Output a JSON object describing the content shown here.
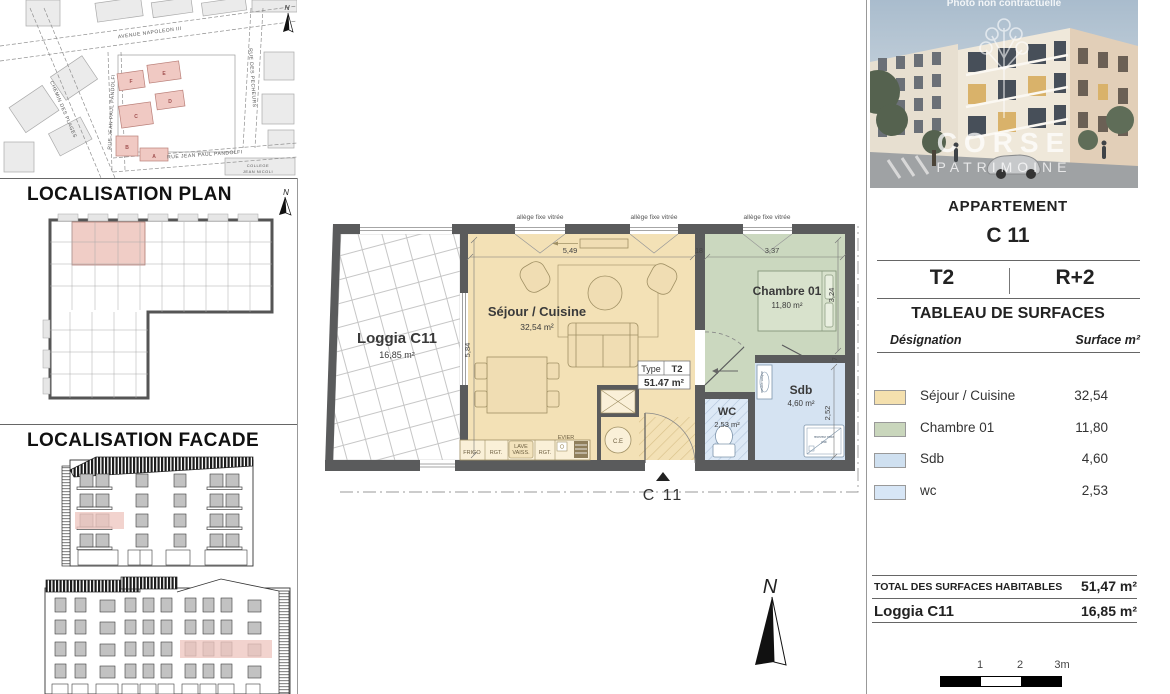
{
  "photo": {
    "caption": "Photo non contractuelle",
    "watermark_line1": "CORSE",
    "watermark_line2": "PATRIMOINE"
  },
  "site_map": {
    "north": "N",
    "streets": {
      "avenue": "AVENUE NAPOLEON III",
      "chemin": "CHEMIN DES PLAGES",
      "pandolfi_v": "RUE JEAN PAUL PANDOLFI",
      "pandolfi_h": "RUE JEAN PAUL PANDOLFI",
      "pecheurs": "RUE DES PECHEURS",
      "college_line1": "COLLEGE",
      "college_line2": "JEAN NICOLI"
    },
    "buildings": {
      "a": "A",
      "b": "B",
      "c": "C",
      "d": "D",
      "e": "E",
      "f": "F"
    }
  },
  "sections": {
    "plan_title": "LOCALISATION PLAN",
    "plan_north": "N",
    "facade_title": "LOCALISATION FACADE"
  },
  "floorplan": {
    "north": "N",
    "window_labels": {
      "w1": "allège fixe vitrée",
      "w2": "allège fixe vitrée",
      "w3": "allège fixe vitrée"
    },
    "rooms": {
      "loggia": {
        "name": "Loggia C11",
        "area": "16,85 m²"
      },
      "sejour": {
        "name": "Séjour / Cuisine",
        "area": "32,54 m²"
      },
      "chambre": {
        "name": "Chambre 01",
        "area": "11,80 m²"
      },
      "sdb": {
        "name": "Sdb",
        "area": "4,60 m²"
      },
      "wc": {
        "name": "WC",
        "area": "2,53 m²"
      }
    },
    "dims": {
      "sejour_w": "5,49",
      "wall_t": "18",
      "chambre_w": "3,37",
      "sejour_h": "5,84",
      "chambre_h": "3,24",
      "sdb_h": "2,52",
      "partition": "7"
    },
    "kitchen": {
      "k1": "FRIGO",
      "k2": "RGT.",
      "k3a": "LAVE",
      "k3b": "VAISS.",
      "k4": "RGT.",
      "k5": "EVIER"
    },
    "fixtures": {
      "ce": "C.E",
      "shower_line1": "receveur extra",
      "shower_line2": "plat",
      "basin": "meuble vasque"
    },
    "type_box": {
      "label": "Type",
      "value": "T2",
      "area": "51.47 m²"
    },
    "entrance": "C 11"
  },
  "panel": {
    "title": "APPARTEMENT",
    "unit": "C 11",
    "type": "T2",
    "floor": "R+2",
    "table_title": "TABLEAU DE SURFACES",
    "col_designation": "Désignation",
    "col_surface": "Surface m²",
    "rows": [
      {
        "label": "Séjour / Cuisine",
        "value": "32,54",
        "color": "#f4e0ae"
      },
      {
        "label": "Chambre 01",
        "value": "11,80",
        "color": "#c9d6bc"
      },
      {
        "label": "Sdb",
        "value": "4,60",
        "color": "#cfe0f0"
      },
      {
        "label": "wc",
        "value": "2,53",
        "color": "#d7e6f6"
      }
    ],
    "total_label": "TOTAL DES SURFACES HABITABLES",
    "total_value": "51,47 m²",
    "loggia_label": "Loggia C11",
    "loggia_value": "16,85 m²",
    "scalebar": {
      "t1": "1",
      "t2": "2",
      "t3": "3m"
    }
  }
}
